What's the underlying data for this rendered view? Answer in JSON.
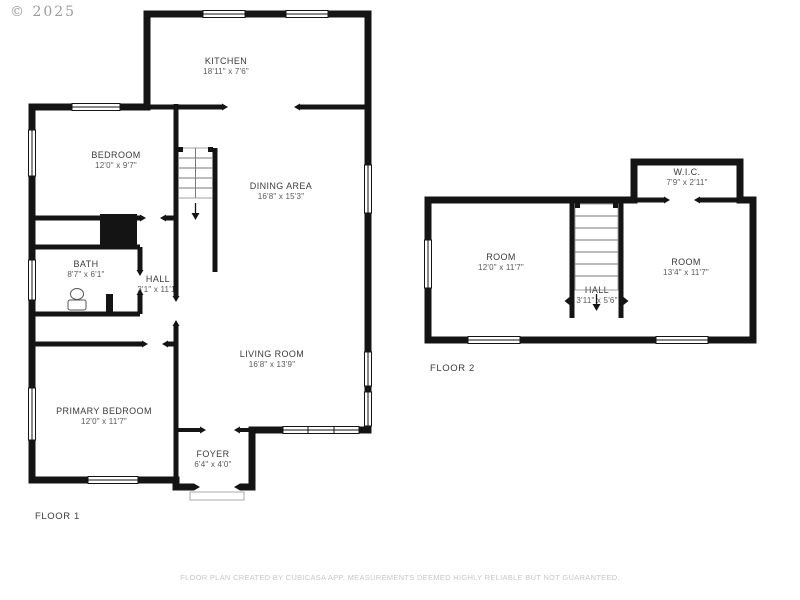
{
  "copyright": "© 2025",
  "disclaimer": "FLOOR PLAN CREATED BY CUBICASA APP. MEASUREMENTS DEEMED HIGHLY RELIABLE BUT NOT GUARANTEED.",
  "colors": {
    "wall": "#141414",
    "room_name": "#3b3b3b",
    "room_dims": "#585858",
    "muted": "#c6c6c6"
  },
  "floor1": {
    "label": "FLOOR 1",
    "rooms": {
      "kitchen": {
        "name": "KITCHEN",
        "dims": "18'11\" x 7'6\""
      },
      "bedroom": {
        "name": "BEDROOM",
        "dims": "12'0\" x 9'7\""
      },
      "dining": {
        "name": "DINING AREA",
        "dims": "16'8\" x 15'3\""
      },
      "bath": {
        "name": "BATH",
        "dims": "8'7\" x 6'1\""
      },
      "hall": {
        "name": "HALL",
        "dims": "3'1\" x 11'1\""
      },
      "living": {
        "name": "LIVING ROOM",
        "dims": "16'8\" x 13'9\""
      },
      "primary": {
        "name": "PRIMARY BEDROOM",
        "dims": "12'0\" x 11'7\""
      },
      "foyer": {
        "name": "FOYER",
        "dims": "6'4\" x 4'0\""
      }
    }
  },
  "floor2": {
    "label": "FLOOR 2",
    "rooms": {
      "wic": {
        "name": "W.I.C.",
        "dims": "7'9\" x 2'11\""
      },
      "room_left": {
        "name": "ROOM",
        "dims": "12'0\" x 11'7\""
      },
      "room_right": {
        "name": "ROOM",
        "dims": "13'4\" x 11'7\""
      },
      "hall": {
        "name": "HALL",
        "dims": "3'11\" x 5'6\""
      }
    }
  }
}
